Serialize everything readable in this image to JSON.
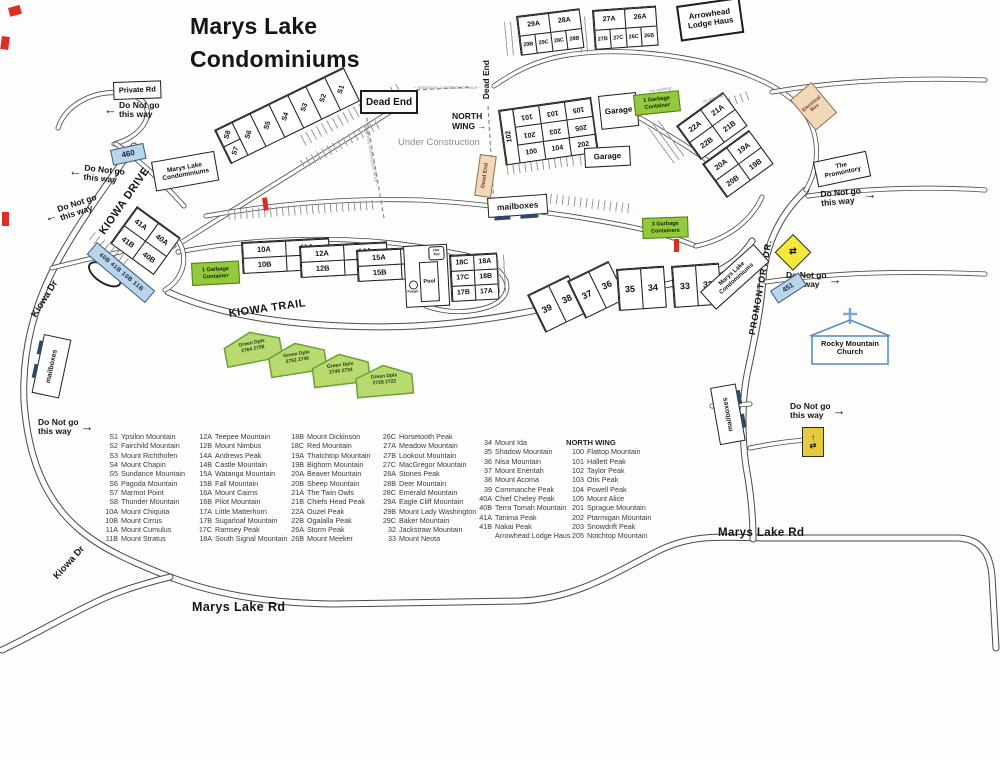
{
  "title": "Marys Lake\nCondominiums",
  "labels": {
    "do_not_go": "Do Not go\nthis way",
    "private_rd": "Private Rd",
    "dead_end": "Dead End",
    "north_wing_arrow": "NORTH\nWING →",
    "under_construction": "Under Construction",
    "temp_fence": "– temporary construction fence –",
    "no_parking": "no parking",
    "mailboxes": "mailboxes",
    "garage": "Garage",
    "garbage1": "1 Garbage\nContainer",
    "garbage3": "3 Garbage\nContainers",
    "pool": "Pool",
    "hot_tub": "Hot\nTub",
    "firepit": "Firepit",
    "arrowhead": "Arrowhead\nLodge Haus",
    "marys_lake_condos": "Marys Lake\nCondominiums",
    "the_promontory": "The\nPromontory",
    "electrical_box": "Electrical\nBox",
    "church": "Rocky Mountain\nChurch",
    "green_dplx": "Green Dplx"
  },
  "roads": {
    "kiowa_drive": "KIOWA DRIVE",
    "kiowa_dr": "Kiowa Dr",
    "kiowa_trail": "KIOWA TRAIL",
    "promontory_dr": "PROMONTORY DR.",
    "marys_lake_rd": "Marys Lake Rd"
  },
  "parking": {
    "p460": "460",
    "p451": "451",
    "strip": "40B 41B 10B 11B"
  },
  "units": {
    "s_left_top": "S8",
    "s_left_bottom": "S7",
    "s_row": [
      "S6",
      "S5",
      "S4",
      "S3",
      "S2",
      "S1"
    ],
    "c29_top": [
      "29A",
      "28A"
    ],
    "c29_bottom": [
      "29B",
      "29C",
      "28C",
      "28B"
    ],
    "c27_top": [
      "27A",
      "26A"
    ],
    "c27_bottom": [
      "27B",
      "27C",
      "26C",
      "26B"
    ],
    "nw_side": "102",
    "nw_flip1": [
      "101",
      "103",
      "105"
    ],
    "nw_flip2": [
      "201",
      "203",
      "205"
    ],
    "nw_up": [
      "100",
      "104",
      "202"
    ],
    "c22_r1": [
      "22A",
      "21A"
    ],
    "c22_r2": [
      "22B",
      "21B"
    ],
    "c20_r1": [
      "20A",
      "19A"
    ],
    "c20_r2": [
      "20B",
      "19B"
    ],
    "c41_r1": [
      "41A",
      "40A"
    ],
    "c41_r2": [
      "41B",
      "40B"
    ],
    "c10_r1": [
      "10A",
      "11A"
    ],
    "c10_r2": [
      "10B",
      "11B"
    ],
    "c12_r1": [
      "12A",
      "14A"
    ],
    "c12_r2": [
      "12B",
      "14B"
    ],
    "c15_r1": [
      "15A",
      "16A"
    ],
    "c15_r2": [
      "15B",
      "16B"
    ],
    "c17_r1": [
      "18C",
      "18A"
    ],
    "c17_r2": [
      "17C",
      "18B"
    ],
    "c17_r3": [
      "17B",
      "17A"
    ],
    "p39": [
      "39",
      "38"
    ],
    "p37": [
      "37",
      "36"
    ],
    "p35": [
      "35",
      "34"
    ],
    "p33": [
      "33",
      "32"
    ]
  },
  "green_duplexes": [
    "2764  2758",
    "2752  2746",
    "2740  2734",
    "2728  2722"
  ],
  "legend": {
    "north_wing_header": "NORTH WING",
    "col1": [
      {
        "id": "S1",
        "name": "Ypsilon Mountain"
      },
      {
        "id": "S2",
        "name": "Fairchild Mountain"
      },
      {
        "id": "S3",
        "name": "Mount Richthofen"
      },
      {
        "id": "S4",
        "name": "Mount Chapin"
      },
      {
        "id": "S5",
        "name": "Sundance Mountain"
      },
      {
        "id": "S6",
        "name": "Pagoda Mountain"
      },
      {
        "id": "S7",
        "name": "Marmot Point"
      },
      {
        "id": "S8",
        "name": "Thunder Mountain"
      },
      {
        "id": "10A",
        "name": "Mount Chiquita"
      },
      {
        "id": "10B",
        "name": "Mount Cirrus"
      },
      {
        "id": "11A",
        "name": "Mount Cumulus"
      },
      {
        "id": "11B",
        "name": "Mount Stratus"
      }
    ],
    "col2": [
      {
        "id": "12A",
        "name": "Teepee Mountain"
      },
      {
        "id": "12B",
        "name": "Mount Nimbus"
      },
      {
        "id": "14A",
        "name": "Andrews Peak"
      },
      {
        "id": "14B",
        "name": "Castle Mountain"
      },
      {
        "id": "15A",
        "name": "Watanga Mountain"
      },
      {
        "id": "15B",
        "name": "Fall Mountain"
      },
      {
        "id": "16A",
        "name": "Mount Cairns"
      },
      {
        "id": "16B",
        "name": "Pilot Mountain"
      },
      {
        "id": "17A",
        "name": "Little Matterhorn"
      },
      {
        "id": "17B",
        "name": "Sugarloaf Mountain"
      },
      {
        "id": "17C",
        "name": "Ramsey Peak"
      },
      {
        "id": "18A",
        "name": "South Signal Mountain"
      }
    ],
    "col3": [
      {
        "id": "18B",
        "name": "Mount Dickinson"
      },
      {
        "id": "18C",
        "name": "Red Mountain"
      },
      {
        "id": "19A",
        "name": "Thatchtop Mountain"
      },
      {
        "id": "19B",
        "name": "Bighorn Mountain"
      },
      {
        "id": "20A",
        "name": "Beaver Mountain"
      },
      {
        "id": "20B",
        "name": "Sheep Mountain"
      },
      {
        "id": "21A",
        "name": "The Twin Owls"
      },
      {
        "id": "21B",
        "name": "Chiefs Head Peak"
      },
      {
        "id": "22A",
        "name": "Ouzel Peak"
      },
      {
        "id": "22B",
        "name": "Ogalalla Peak"
      },
      {
        "id": "26A",
        "name": "Storm Peak"
      },
      {
        "id": "26B",
        "name": "Mount Meeker"
      }
    ],
    "col4": [
      {
        "id": "26C",
        "name": "Horsetooth Peak"
      },
      {
        "id": "27A",
        "name": "Meadow Mountain"
      },
      {
        "id": "27B",
        "name": "Lookout Mountain"
      },
      {
        "id": "27C",
        "name": "MacGregor Mountain"
      },
      {
        "id": "28A",
        "name": "Stones Peak"
      },
      {
        "id": "28B",
        "name": "Deer Mountain"
      },
      {
        "id": "28C",
        "name": "Emerald Mountain"
      },
      {
        "id": "29A",
        "name": "Eagle Cliff Mountain"
      },
      {
        "id": "29B",
        "name": "Mount Lady Washington"
      },
      {
        "id": "29C",
        "name": "Baker Mountain"
      },
      {
        "id": "32",
        "name": "Jackstraw Mountain"
      },
      {
        "id": "33",
        "name": "Mount Neota"
      }
    ],
    "col5": [
      {
        "id": "34",
        "name": "Mount Ida"
      },
      {
        "id": "35",
        "name": "Shadow Mountain"
      },
      {
        "id": "36",
        "name": "Nisa Mountain"
      },
      {
        "id": "37",
        "name": "Mount Enentah"
      },
      {
        "id": "38",
        "name": "Mount Acoma"
      },
      {
        "id": "39",
        "name": "Commanche Peak"
      },
      {
        "id": "40A",
        "name": "Chief Cheley Peak"
      },
      {
        "id": "40B",
        "name": "Terra Tomah Mountain"
      },
      {
        "id": "41A",
        "name": "Tanima Peak"
      },
      {
        "id": "41B",
        "name": "Nakai Peak"
      },
      {
        "id": "",
        "name": "Arrowhead Lodge Haus"
      }
    ],
    "col6": [
      {
        "id": "100",
        "name": "Flattop Mountain"
      },
      {
        "id": "101",
        "name": "Hallett Peak"
      },
      {
        "id": "102",
        "name": "Taylor Peak"
      },
      {
        "id": "103",
        "name": "Otis Peak"
      },
      {
        "id": "104",
        "name": "Powell Peak"
      },
      {
        "id": "105",
        "name": "Mount Alice"
      },
      {
        "id": "201",
        "name": "Sprague Mountain"
      },
      {
        "id": "202",
        "name": "Ptarmigan Mountain"
      },
      {
        "id": "203",
        "name": "Snowdrift Peak"
      },
      {
        "id": "205",
        "name": "Notchtop Mountain"
      }
    ]
  }
}
